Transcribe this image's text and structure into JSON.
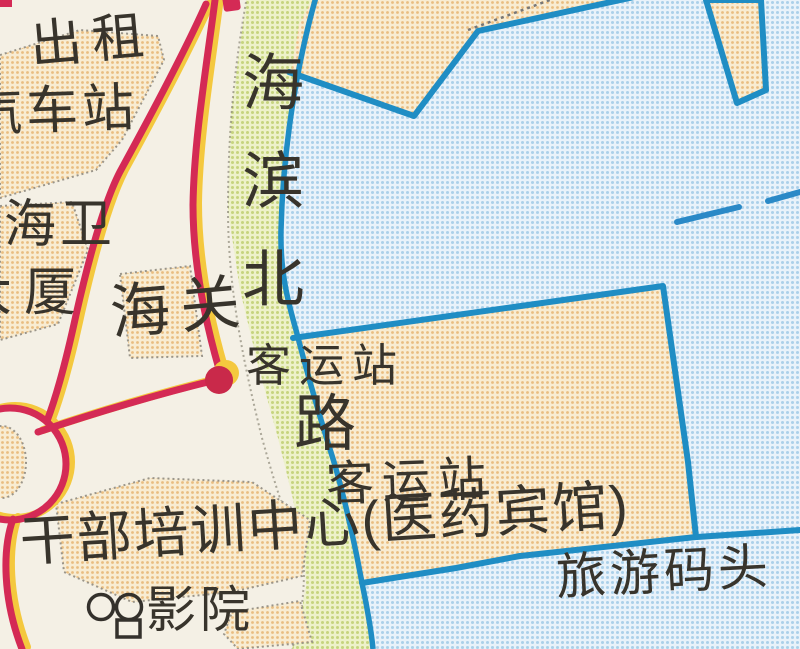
{
  "map": {
    "kind": "scanned-street-map",
    "labels": {
      "taxi_station": {
        "line1": "出租",
        "line2": "汽车站"
      },
      "haiwei_building": {
        "line1": "海卫",
        "line2": "大厦"
      },
      "customs": "海关",
      "coastal_road": {
        "full": "海滨北路",
        "vertical_part": "海滨北",
        "tail_char": "路"
      },
      "passenger_station_marker": "客运站",
      "passenger_station_area": "客运站",
      "training_center": "干部培训中心(医药宾馆)",
      "cinema": "影院",
      "tourist_wharf": "旅游码头"
    },
    "icons": {
      "station_dot": "red-filled-circle-station-marker",
      "cinema_projector": "double-circle-film-projector",
      "ferry_route": "dashed-blue-line"
    },
    "colors": {
      "paper": "#f4f0e5",
      "water_tone": "#c6ddee",
      "land_tan_tone": "#f0d7a0",
      "green_strip_tone": "#dde9a8",
      "shoreline_blue": "#1f8dc4",
      "road_red": "#d42a55",
      "casing_yellow": "#f4c83e",
      "marker_red": "#c9294a",
      "text_ink": "#38342c"
    }
  }
}
